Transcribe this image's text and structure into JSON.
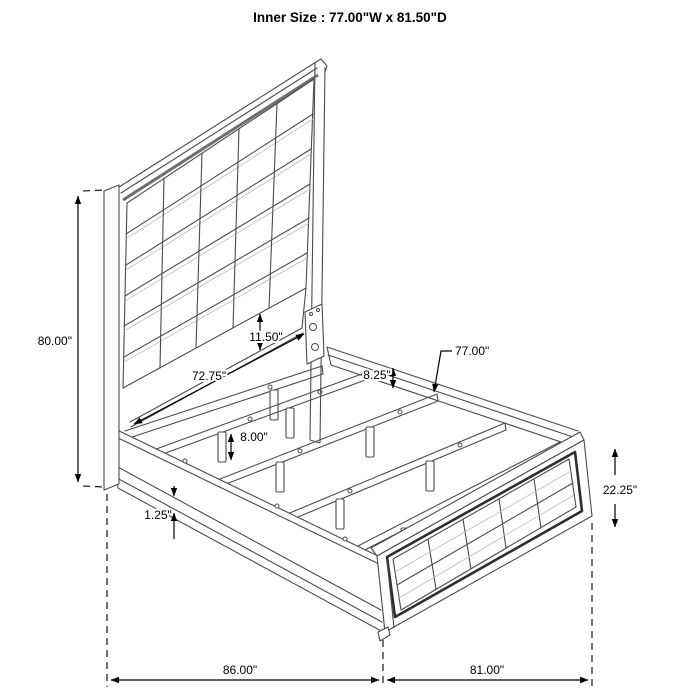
{
  "title": "Inner Size : 77.00\"W x 81.50\"D",
  "dimensions": {
    "headboard_height": "80.00\"",
    "panel_gap": "11.50\"",
    "headboard_width": "72.75\"",
    "rail_drop": "8.25\"",
    "slat_length": "77.00\"",
    "leg_height": "8.00\"",
    "rail_lip": "1.25\"",
    "footboard_height": "22.25\"",
    "overall_depth": "86.00\"",
    "overall_width": "81.00\""
  },
  "colors": {
    "line": "#4b4b4b",
    "dimension": "#000000",
    "background": "#ffffff",
    "dark_trim": "#2e2e2e"
  }
}
